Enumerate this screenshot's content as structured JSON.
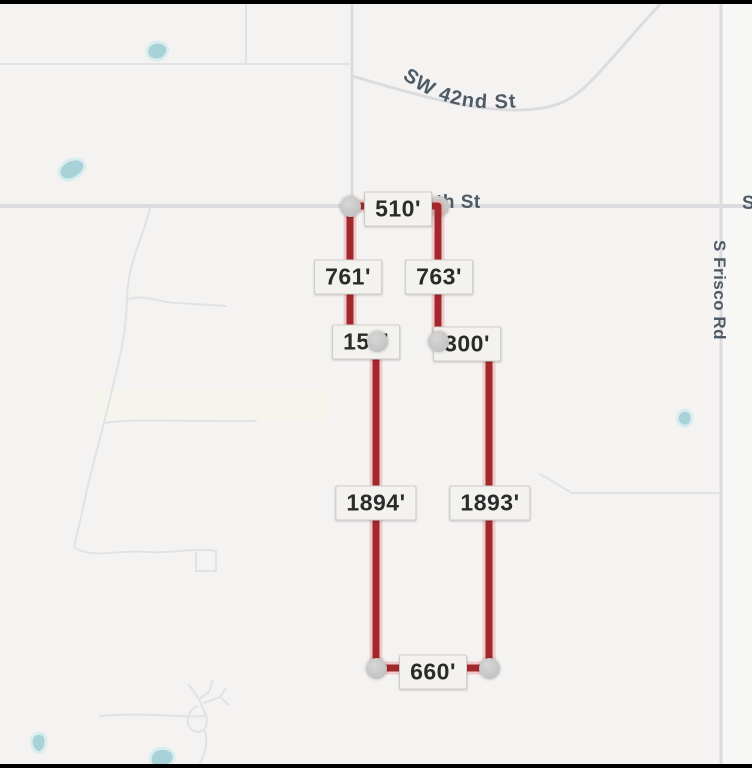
{
  "map": {
    "streets": {
      "sw_42nd": "SW 42nd St",
      "s_frisco": "S Frisco Rd",
      "th_st_partial": "th St",
      "s_partial": "S"
    },
    "colors": {
      "background": "#f4f3f2",
      "road": "#dcdce0",
      "minor_road": "#e2e2e6",
      "water": "#a7d2d8",
      "street_text": "#4e5b66"
    }
  },
  "measure": {
    "line_color": "#a3282d",
    "endpoint_color": "#c7c7c7",
    "labels": [
      "510'",
      "761'",
      "763'",
      "150'",
      "300'",
      "1894'",
      "1893'",
      "660'"
    ]
  }
}
